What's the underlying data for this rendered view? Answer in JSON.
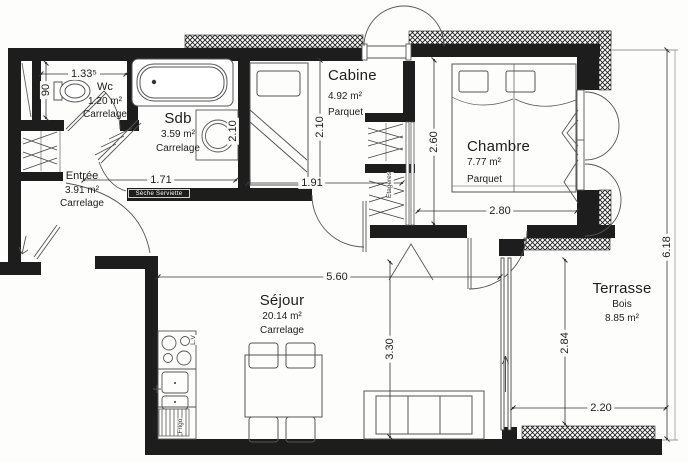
{
  "rooms": {
    "wc": {
      "name": "Wc",
      "area": "1.20 m²",
      "floor": "Carrelage"
    },
    "sdb": {
      "name": "Sdb",
      "area": "3.59 m²",
      "floor": "Carrelage"
    },
    "entree": {
      "name": "Entrée",
      "area": "3.91 m²",
      "floor": "Carrelage"
    },
    "cabine": {
      "name": "Cabine",
      "area": "4.92 m²",
      "floor": "Parquet"
    },
    "chambre": {
      "name": "Chambre",
      "area": "7.77 m²",
      "floor": "Parquet"
    },
    "sejour": {
      "name": "Séjour",
      "area": "20.14 m²",
      "floor": "Carrelage"
    },
    "terrasse": {
      "name": "Terrasse",
      "area": "8.85 m²",
      "floor": "Bois"
    }
  },
  "dims": {
    "wc_width": "1.33⁵",
    "wc_depth": "90",
    "sdb_width": "1.71",
    "sdb_height": "2.10",
    "cabine_height": "2.10",
    "cabine_width": "1.91",
    "chambre_height": "2.60",
    "chambre_width": "2.80",
    "sejour_width": "5.60",
    "sejour_height": "3.30",
    "terrasse_height": "2.84",
    "terrasse_width": "2.20",
    "building_depth": "6.18"
  },
  "annotations": {
    "towel_dryer": "Sèche Serviette",
    "shelves": "Etagères",
    "fridge": "Frigo",
    "dishwasher": "L.V"
  },
  "colors": {
    "wall": "#1d1d1d",
    "line": "#555555",
    "dim_line": "#333333",
    "background": "#fdfdfc"
  }
}
